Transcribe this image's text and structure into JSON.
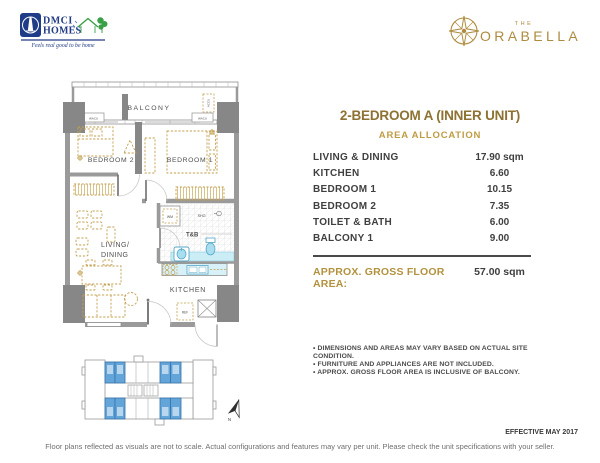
{
  "header": {
    "dmci_logo": {
      "line1": "DMCI",
      "line2": "HOMES",
      "tagline": "Feels real good to be home"
    },
    "orabella_logo": {
      "the": "THE",
      "name": "ORABELLA"
    }
  },
  "unit_panel": {
    "title": "2-BEDROOM A (INNER UNIT)",
    "subtitle": "AREA ALLOCATION",
    "rows": [
      {
        "label": "LIVING & DINING",
        "value": "17.90 sqm"
      },
      {
        "label": "KITCHEN",
        "value": "6.60"
      },
      {
        "label": "BEDROOM 1",
        "value": "10.15"
      },
      {
        "label": "BEDROOM 2",
        "value": "7.35"
      },
      {
        "label": "TOILET & BATH",
        "value": "6.00"
      },
      {
        "label": "BALCONY 1",
        "value": "9.00"
      }
    ],
    "total_label": "APPROX. GROSS FLOOR AREA:",
    "total_value": "57.00 sqm",
    "notes": [
      "• DIMENSIONS AND AREAS MAY VARY BASED ON ACTUAL SITE CONDITION.",
      "• FURNITURE AND APPLIANCES ARE NOT INCLUDED.",
      "• APPROX. GROSS FLOOR AREA IS INCLUSIVE OF BALCONY."
    ]
  },
  "floorplan": {
    "labels": {
      "balcony": "BALCONY",
      "bedroom2": "BEDROOM 2",
      "bedroom1": "BEDROOM 1",
      "living_line1": "LIVING/",
      "living_line2": "DINING",
      "toilet_bath": "T&B",
      "kitchen": "KITCHEN",
      "washing_machine": "WM",
      "shower": "SHO.",
      "refrigerator": "REF",
      "wacu_left": "WACU",
      "wacu_right": "WACU",
      "accu": "ACCU"
    }
  },
  "keyplan": {
    "north_label": "N"
  },
  "footer": {
    "effective_date": "EFFECTIVE MAY 2017",
    "disclaimer": "Floor plans reflected as visuals are not to scale. Actual configurations and features may vary per unit. Please check the unit specifications with your seller."
  },
  "colors": {
    "gold_dark": "#8d7231",
    "gold": "#b3923e",
    "furniture_gold": "#c3a04f",
    "text_dark": "#3f3f3f",
    "wall_gray": "#9a9a9a",
    "column_gray": "#848484",
    "fixture_blue": "#53a7c6",
    "fixture_fill": "#cdebf5",
    "keyplan_unit_blue": "#63a5d8",
    "dmci_blue": "#233b84",
    "dmci_green": "#3aa048"
  }
}
